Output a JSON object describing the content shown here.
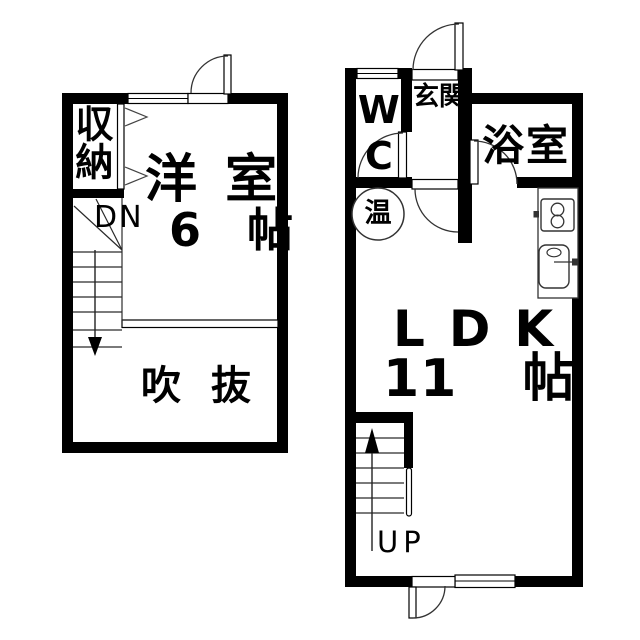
{
  "document": {
    "kind": "apartment-floor-plan",
    "floors_shown": 2
  },
  "colors": {
    "wall": "#000000",
    "background": "#ffffff",
    "thin_line": "#2a2a2a"
  },
  "floor2": {
    "closet_label": "収納",
    "down_label": "DN",
    "room_label": "洋 室",
    "room_size_label": "6 帖",
    "void_label": "吹 抜"
  },
  "floor1": {
    "wc_label": "WC",
    "entrance_label": "玄関",
    "bath_label": "浴室",
    "heater_label": "温",
    "ldk_label": "LDK",
    "ldk_size_label": "11 帖",
    "up_label": "UP"
  },
  "symbols": {
    "stove_icon": "two-burner-stove",
    "sink_icon": "kitchen-sink-with-faucet",
    "heater_icon": "water-heater-circle",
    "stair_down_icon": "down-arrow",
    "stair_up_icon": "up-arrow",
    "closet_door_icon": "folding-door-chevrons"
  }
}
